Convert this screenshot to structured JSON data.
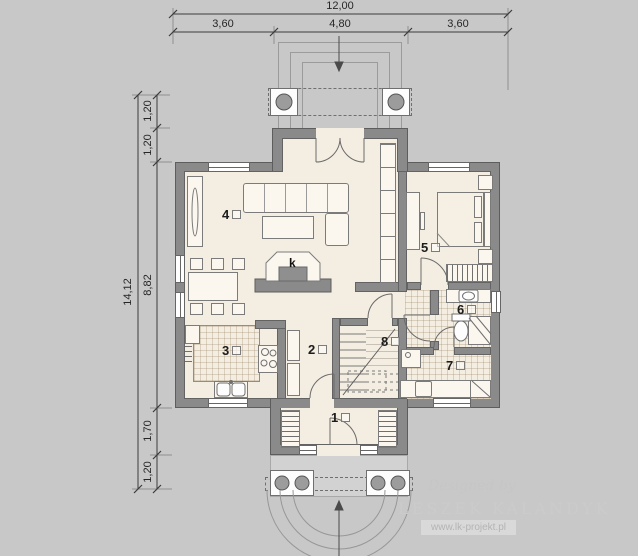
{
  "colors": {
    "background": "#c8c8c8",
    "wall": "#8a8a8a",
    "floor": "#f4ede1",
    "porch_slab": "#d2d2d2",
    "linework": "#6e6e6e"
  },
  "dimensions": {
    "top": {
      "total": "12,00",
      "segments": [
        "3,60",
        "4,80",
        "3,60"
      ]
    },
    "left": {
      "total": "14,12",
      "segments": [
        "1,20",
        "1,20",
        "8,82",
        "1,70",
        "1,20"
      ]
    }
  },
  "rooms": [
    {
      "number": "1"
    },
    {
      "number": "2"
    },
    {
      "number": "3"
    },
    {
      "number": "4"
    },
    {
      "number": "5"
    },
    {
      "number": "6"
    },
    {
      "number": "7"
    },
    {
      "number": "8"
    }
  ],
  "fireplace_label": "k",
  "watermark": {
    "designed_by": "Designed by",
    "author": "LESZEK KALANDYK",
    "website": "www.lk-projekt.pl"
  }
}
